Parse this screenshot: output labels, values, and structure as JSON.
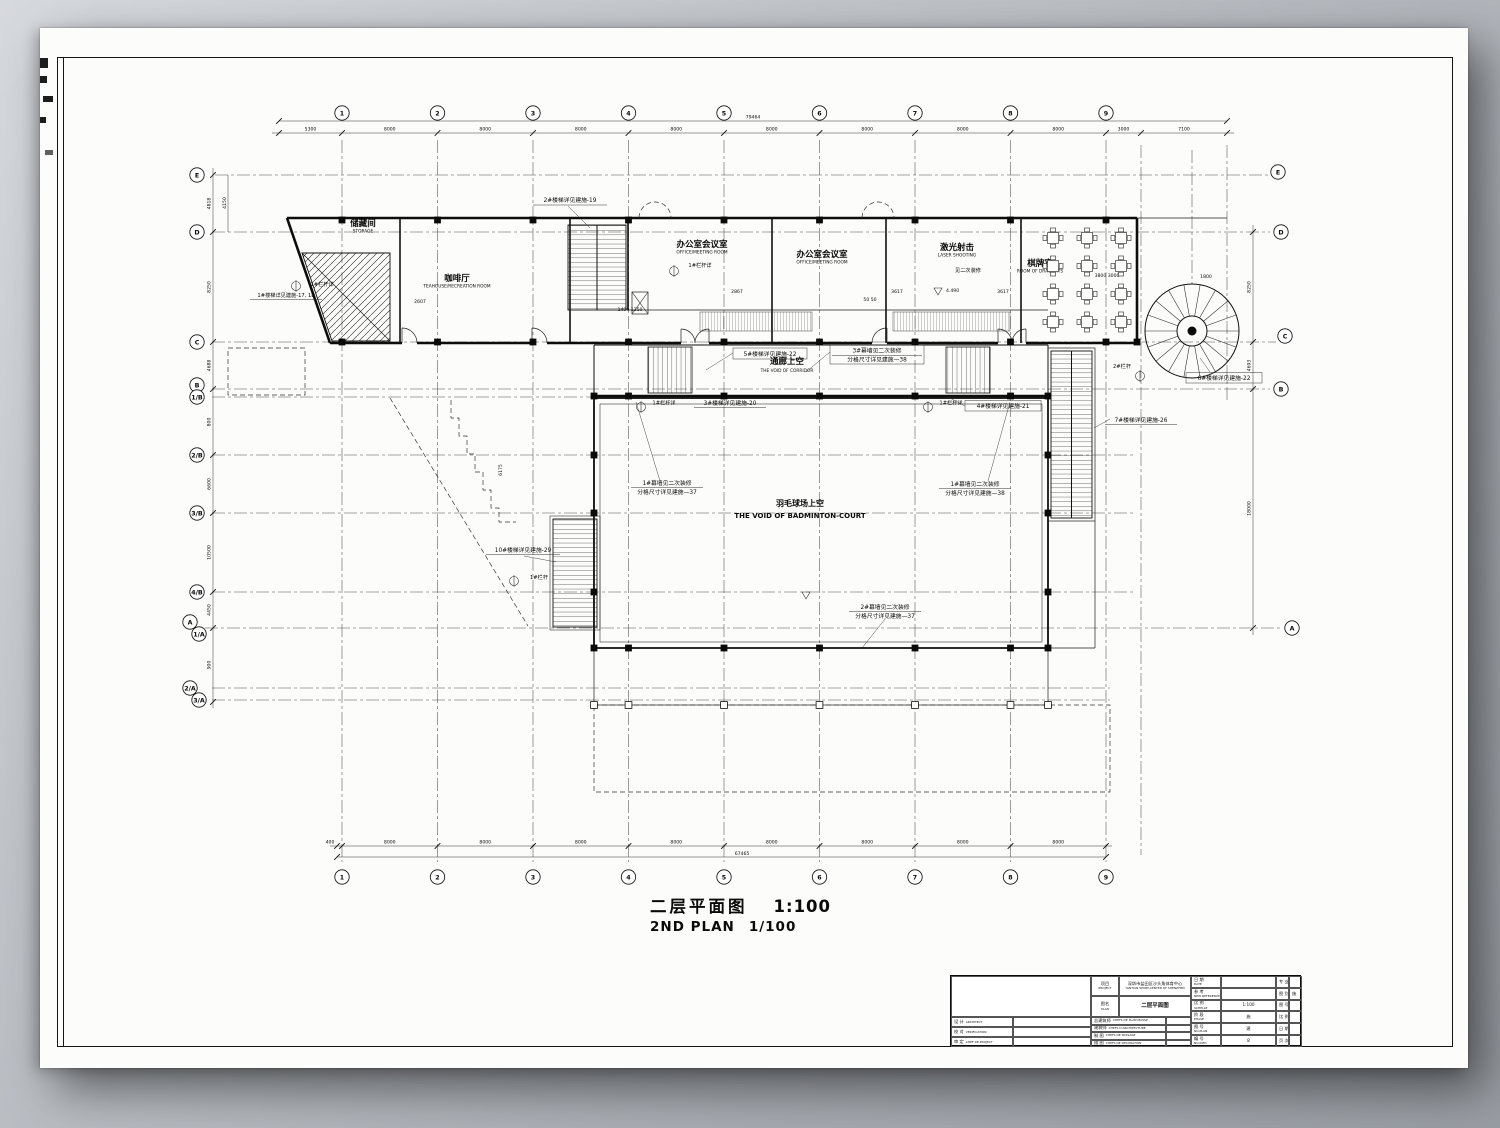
{
  "page": {
    "drawing_title_zh": "二层平面图",
    "drawing_title_scale": "1:100",
    "drawing_title_en": "2ND PLAN",
    "drawing_title_scale_en": "1/100"
  },
  "grid": {
    "cols": [
      "1",
      "2",
      "3",
      "4",
      "5",
      "6",
      "7",
      "8",
      "9"
    ],
    "rows_left": [
      "E",
      "D",
      "C",
      "B",
      "1/B",
      "2/B",
      "3/B",
      "4/B",
      "A",
      "1/A",
      "2/A",
      "3/A"
    ],
    "rows_right": [
      "E",
      "D",
      "C",
      "B",
      "A"
    ]
  },
  "dimensions": {
    "top_total": "79464",
    "top_segments": [
      "5300",
      "8000",
      "8000",
      "8000",
      "8000",
      "8000",
      "8000",
      "8000",
      "8000",
      "3000",
      "7100"
    ],
    "bottom_total": "67465",
    "bottom_segments": [
      "400",
      "8000",
      "8000",
      "8000",
      "8000",
      "8000",
      "8000",
      "8000",
      "8000"
    ],
    "left_segments": [
      "4818",
      "8250",
      "4688",
      "800",
      "6600",
      "10500",
      "4450",
      "900"
    ],
    "left_extra": "4150",
    "right_segments": [
      "8250",
      "4693",
      "18000"
    ]
  },
  "rooms": {
    "storage": {
      "zh": "储藏间",
      "en": "STORAGE"
    },
    "cafe": {
      "zh": "咖啡厅",
      "en": "TEAHOUSE/RECREATION ROOM"
    },
    "office1": {
      "zh": "办公室会议室",
      "en": "OFFICE/MEETING ROOM"
    },
    "office2": {
      "zh": "办公室会议室",
      "en": "OFFICE/MEETING ROOM"
    },
    "laser": {
      "zh": "激光射击",
      "en": "LASER SHOOTING"
    },
    "chess": {
      "zh": "棋牌室",
      "en": "ROOM OF DRAUGHTS"
    },
    "corridor": {
      "zh": "通廊上空",
      "en": "THE VOID OF CORRIDOR"
    },
    "court": {
      "zh": "羽毛球场上空",
      "en": "THE VOID OF BADMINTON-COURT"
    }
  },
  "notes": {
    "stair1": "1#楼梯详见建施-17, 18",
    "stair2": "2#楼梯详见建施-19",
    "stair3": "3#楼梯详见建施-20",
    "stair4": "4#楼梯详见建施-21",
    "stair5": "5#楼梯详见建施-22",
    "stair6": "6#楼梯详见建施-22",
    "stair7": "7#楼梯详见建施-26",
    "stair10": "10#楼梯详见建施-29",
    "rail1": "1#栏杆详",
    "rail1s": "1#栏杆",
    "rail2": "2#栏杆",
    "decor": "见二次装修",
    "cw1_l1": "1#幕墙见二次装修",
    "cw1_l2": "分格尺寸详见建施—37",
    "cw1b_l1": "1#幕墙见二次装修",
    "cw1b_l2": "分格尺寸详见建施—38",
    "cw2_l1": "2#幕墙见二次装修",
    "cw2_l2": "分格尺寸详见建施—37",
    "cw3_l1": "3#幕墙见二次装修",
    "cw3_l2": "分格尺寸详见建施—38",
    "level": "4.490"
  },
  "plan_dims": {
    "a": "2867",
    "b": "3617",
    "c": "3617",
    "d": "50 50",
    "e": "1400 1250",
    "f": "1800",
    "g": "3800 3000",
    "h": "2607",
    "i": "6175"
  },
  "title_block": {
    "sig_rows": [
      {
        "zh": "设 计",
        "en": "ARCHITECT"
      },
      {
        "zh": "校 对",
        "en": "VERIFICATION"
      },
      {
        "zh": "审 定",
        "en": "CHEF DE PROJECT"
      }
    ],
    "project_label_zh": "项目",
    "project_label_en": "PROJECT",
    "project_name_zh": "深圳市盐田区沙头角体育中心",
    "project_name_en": "YANTIAN SPORT-CENTER OF SHENZHEN",
    "plan_label_zh": "图名",
    "plan_label_en": "PLAN",
    "plan_name": "二层平面图",
    "role_rows": [
      {
        "zh": "总建筑师",
        "en": "CHEFS DE PLAN MASSE"
      },
      {
        "zh": "建筑师",
        "en": "CHEFS D'ARCHITECTURE"
      },
      {
        "zh": "制 图",
        "en": "CHEFS DE PASSAGE"
      },
      {
        "zh": "描 图",
        "en": "CHEFS DE DECORATION"
      }
    ],
    "meta_rows": [
      {
        "zh": "日 期",
        "en": "DATE",
        "val": ""
      },
      {
        "zh": "参 考",
        "en": "NEW REFERENCE",
        "val": ""
      },
      {
        "zh": "比 例",
        "en": "SCHELLE",
        "val": "1:100"
      },
      {
        "zh": "阶 段",
        "en": "PHASE",
        "val": "施"
      },
      {
        "zh": "图 号",
        "en": "NO.PLAN",
        "val": "建"
      },
      {
        "zh": "编 号",
        "en": "NO.INFO",
        "val": "8"
      }
    ],
    "side_rows": [
      {
        "label": "专 业",
        "val": ""
      },
      {
        "label": "图 别",
        "val": "施"
      },
      {
        "label": "图 号",
        "val": ""
      },
      {
        "label": "比 例",
        "val": ""
      },
      {
        "label": "日 期",
        "val": ""
      },
      {
        "label": "页 次",
        "val": ""
      }
    ]
  }
}
